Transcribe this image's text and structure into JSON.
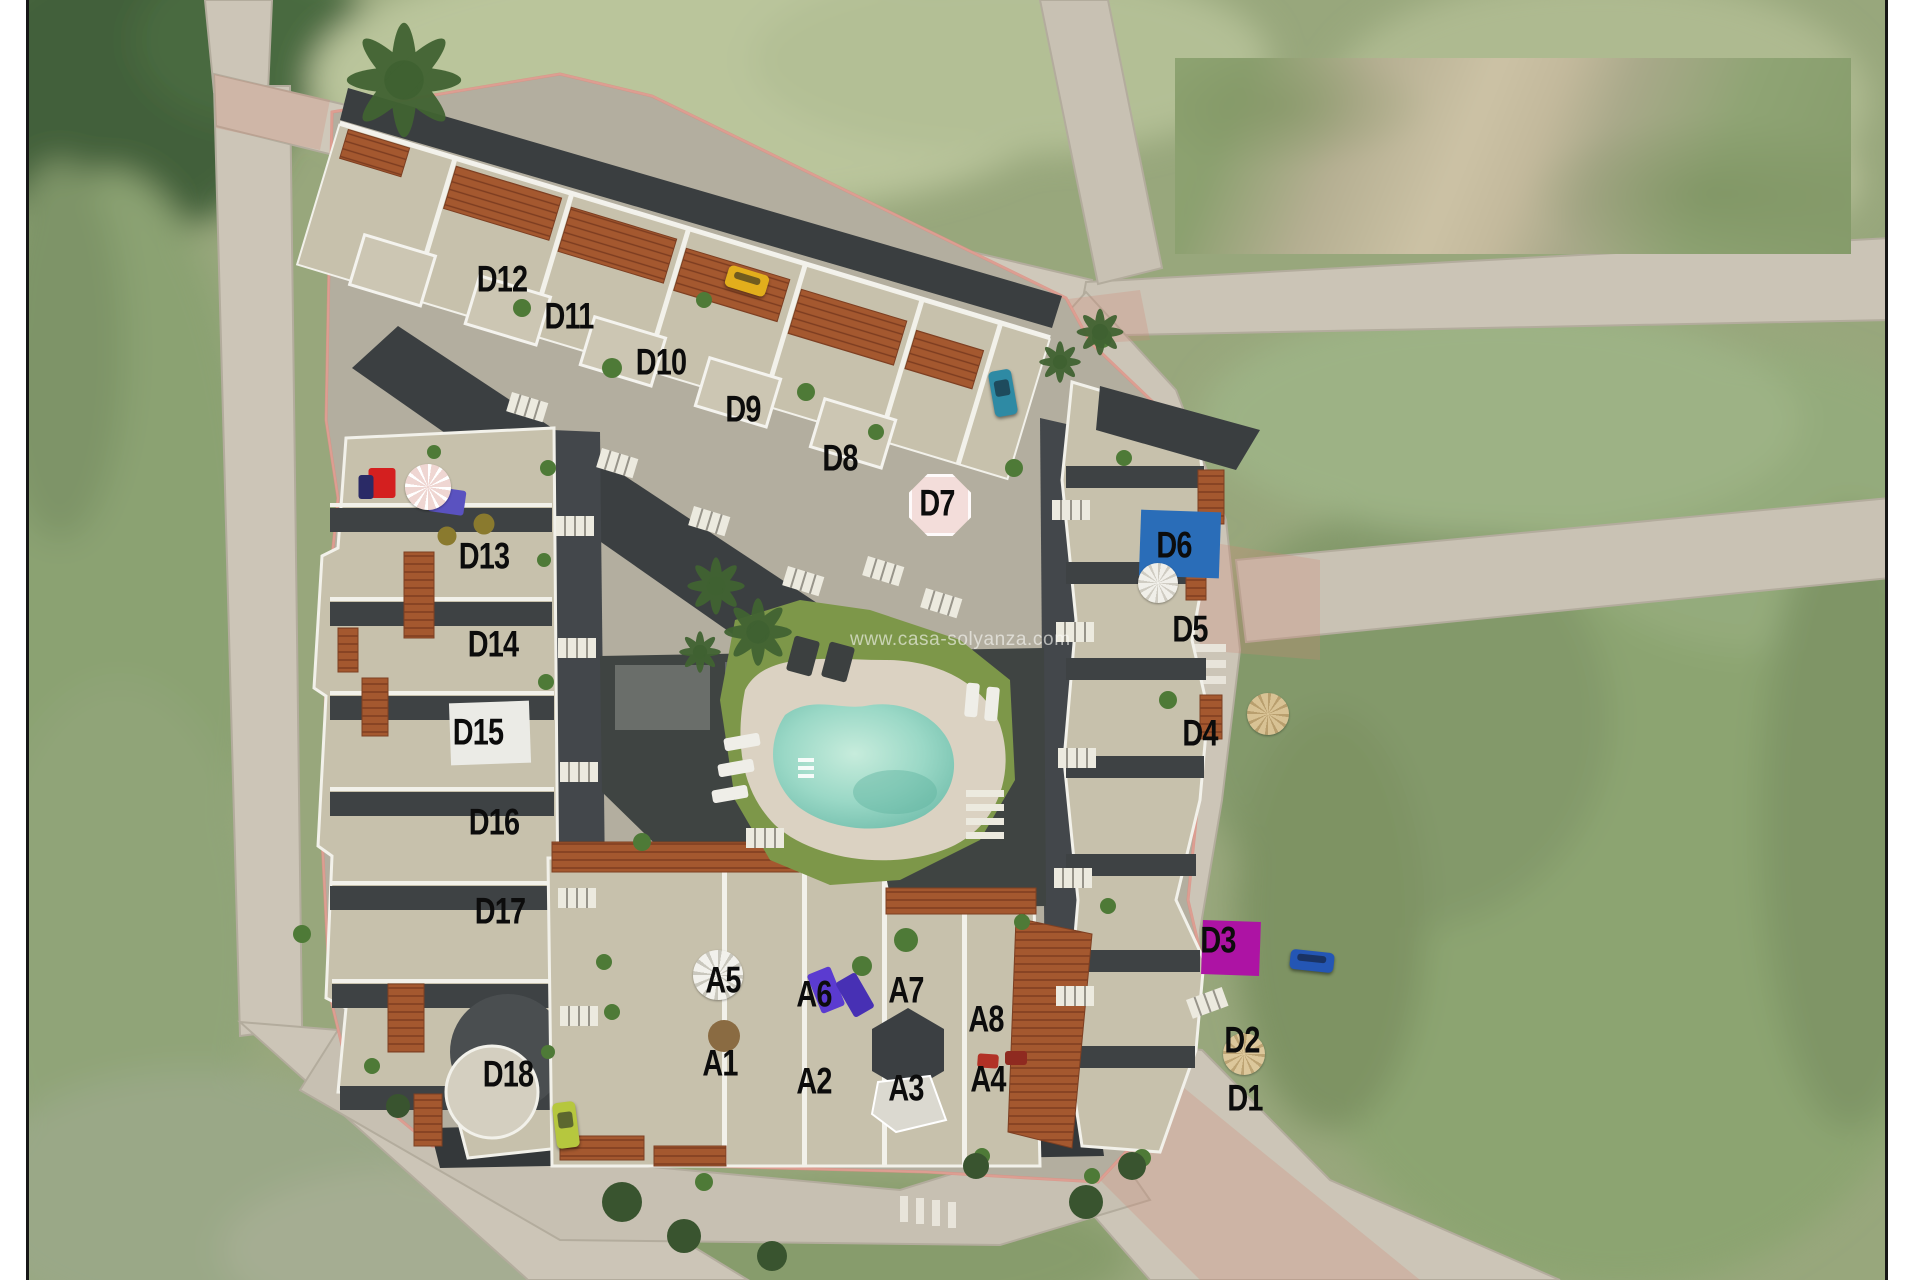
{
  "image": {
    "kind": "aerial-site-plan",
    "width": 1920,
    "height": 1280
  },
  "watermark": {
    "text": "www.casa-solyanza.com"
  },
  "units": [
    {
      "id": "D12",
      "x": 502,
      "y": 279
    },
    {
      "id": "D11",
      "x": 569,
      "y": 316
    },
    {
      "id": "D10",
      "x": 661,
      "y": 362
    },
    {
      "id": "D9",
      "x": 743,
      "y": 409
    },
    {
      "id": "D8",
      "x": 840,
      "y": 458
    },
    {
      "id": "D7",
      "x": 937,
      "y": 503
    },
    {
      "id": "D13",
      "x": 484,
      "y": 556
    },
    {
      "id": "D14",
      "x": 493,
      "y": 644
    },
    {
      "id": "D15",
      "x": 478,
      "y": 732
    },
    {
      "id": "D16",
      "x": 494,
      "y": 822
    },
    {
      "id": "D17",
      "x": 500,
      "y": 911
    },
    {
      "id": "D18",
      "x": 508,
      "y": 1074
    },
    {
      "id": "D6",
      "x": 1174,
      "y": 545
    },
    {
      "id": "D5",
      "x": 1190,
      "y": 629
    },
    {
      "id": "D4",
      "x": 1200,
      "y": 733
    },
    {
      "id": "D3",
      "x": 1218,
      "y": 940
    },
    {
      "id": "D2",
      "x": 1242,
      "y": 1040
    },
    {
      "id": "D1",
      "x": 1245,
      "y": 1098
    },
    {
      "id": "A5",
      "x": 723,
      "y": 980
    },
    {
      "id": "A6",
      "x": 814,
      "y": 994
    },
    {
      "id": "A7",
      "x": 906,
      "y": 990
    },
    {
      "id": "A8",
      "x": 986,
      "y": 1019
    },
    {
      "id": "A1",
      "x": 720,
      "y": 1063
    },
    {
      "id": "A2",
      "x": 814,
      "y": 1081
    },
    {
      "id": "A3",
      "x": 906,
      "y": 1088
    },
    {
      "id": "A4",
      "x": 988,
      "y": 1079
    }
  ],
  "markers": [
    {
      "unit": "D15",
      "shape": "rect",
      "color": "#ebebe6",
      "x": 490,
      "y": 733,
      "w": 80,
      "h": 62,
      "rot": -2
    },
    {
      "unit": "D6",
      "shape": "rect",
      "color": "#2a6db8",
      "x": 1180,
      "y": 544,
      "w": 80,
      "h": 66,
      "rot": 2
    },
    {
      "unit": "D3",
      "shape": "rect",
      "color": "#ad13a4",
      "x": 1231,
      "y": 948,
      "w": 58,
      "h": 54,
      "rot": 2
    },
    {
      "unit": "D7",
      "shape": "octagon",
      "color": "#f3ddda",
      "x": 940,
      "y": 505,
      "w": 62,
      "h": 62,
      "rot": 0
    }
  ],
  "vehicles": [
    {
      "name": "yellow-car",
      "color": "#e2ae1c",
      "x": 747,
      "y": 281,
      "w": 42,
      "h": 22,
      "rot": 17
    },
    {
      "name": "teal-car",
      "color": "#2e8aa4",
      "x": 1003,
      "y": 393,
      "w": 23,
      "h": 46,
      "rot": -10
    },
    {
      "name": "blue-car",
      "color": "#2456b4",
      "x": 1312,
      "y": 961,
      "w": 44,
      "h": 20,
      "rot": 6
    },
    {
      "name": "green-car",
      "color": "#b6c73e",
      "x": 566,
      "y": 1125,
      "w": 23,
      "h": 46,
      "rot": -7
    }
  ],
  "parasols": [
    {
      "name": "pink-parasol",
      "x": 428,
      "y": 487,
      "r": 23,
      "base": "#efd6d2",
      "spoke": "#ffffff"
    },
    {
      "name": "white-parasol",
      "x": 718,
      "y": 975,
      "r": 25,
      "base": "#f2f1ec",
      "spoke": "#c9c7bd"
    },
    {
      "name": "white-parasol",
      "x": 1158,
      "y": 583,
      "r": 20,
      "base": "#f0efe9",
      "spoke": "#cfccc2"
    },
    {
      "name": "tan-parasol",
      "x": 1268,
      "y": 714,
      "r": 21,
      "base": "#d8c294",
      "spoke": "#b99f6e"
    },
    {
      "name": "tan-parasol",
      "x": 1244,
      "y": 1054,
      "r": 21,
      "base": "#dcc79b",
      "spoke": "#bda474"
    }
  ],
  "props": [
    {
      "name": "red-patio-furniture",
      "shape": "rect",
      "color": "#d41f1f",
      "x": 382,
      "y": 483,
      "w": 27,
      "h": 30,
      "rot": 0
    },
    {
      "name": "navy-patio-furniture",
      "shape": "rect",
      "color": "#2a2a66",
      "x": 366,
      "y": 487,
      "w": 15,
      "h": 24,
      "rot": 0
    },
    {
      "name": "purple-sofa",
      "shape": "rect",
      "color": "#5a52c0",
      "x": 447,
      "y": 501,
      "w": 36,
      "h": 25,
      "rot": 8
    },
    {
      "name": "olive-table",
      "shape": "circle",
      "color": "#8a7a2e",
      "x": 447,
      "y": 536,
      "w": 19,
      "h": 19,
      "rot": 0
    },
    {
      "name": "olive-table",
      "shape": "circle",
      "color": "#8a7a2e",
      "x": 484,
      "y": 524,
      "w": 21,
      "h": 21,
      "rot": 0
    },
    {
      "name": "purple-towel",
      "shape": "rect",
      "color": "#5b3bd0",
      "x": 826,
      "y": 990,
      "w": 25,
      "h": 42,
      "rot": -22
    },
    {
      "name": "purple-towel",
      "shape": "rect",
      "color": "#4730b4",
      "x": 855,
      "y": 995,
      "w": 23,
      "h": 40,
      "rot": -30
    },
    {
      "name": "barbecue",
      "shape": "rect",
      "color": "#b23126",
      "x": 988,
      "y": 1061,
      "w": 21,
      "h": 14,
      "rot": 4
    },
    {
      "name": "barbecue",
      "shape": "rect",
      "color": "#8f2a20",
      "x": 1016,
      "y": 1058,
      "w": 22,
      "h": 14,
      "rot": 0
    },
    {
      "name": "dry-plant",
      "shape": "circle",
      "color": "#8a6b42",
      "x": 724,
      "y": 1036,
      "w": 32,
      "h": 32,
      "rot": 0
    },
    {
      "name": "dark-lounger",
      "shape": "rect",
      "color": "#3c4040",
      "x": 803,
      "y": 656,
      "w": 26,
      "h": 36,
      "rot": 15
    },
    {
      "name": "dark-lounger",
      "shape": "rect",
      "color": "#3c4040",
      "x": 838,
      "y": 662,
      "w": 26,
      "h": 36,
      "rot": 15
    },
    {
      "name": "white-lounger",
      "shape": "rect",
      "color": "#efeee8",
      "x": 742,
      "y": 742,
      "w": 36,
      "h": 13,
      "rot": -10
    },
    {
      "name": "white-lounger",
      "shape": "rect",
      "color": "#efeee8",
      "x": 736,
      "y": 768,
      "w": 36,
      "h": 13,
      "rot": -10
    },
    {
      "name": "white-lounger",
      "shape": "rect",
      "color": "#efeee8",
      "x": 730,
      "y": 794,
      "w": 36,
      "h": 13,
      "rot": -10
    },
    {
      "name": "white-lounger",
      "shape": "rect",
      "color": "#efeee8",
      "x": 972,
      "y": 700,
      "w": 13,
      "h": 34,
      "rot": 5
    },
    {
      "name": "white-lounger",
      "shape": "rect",
      "color": "#efeee8",
      "x": 992,
      "y": 704,
      "w": 13,
      "h": 34,
      "rot": 5
    }
  ],
  "colors": {
    "pool_water": "#8fd0bd",
    "lawn": "#7d9749",
    "roof_beige": "#c7c1ac",
    "terracotta": "#a4582f",
    "road": "#ccc5b7",
    "dark_terrace": "#3f4442",
    "marker_blue": "#2a6db8",
    "marker_magenta": "#ad13a4",
    "boundary_pink": "#dc8f82"
  }
}
